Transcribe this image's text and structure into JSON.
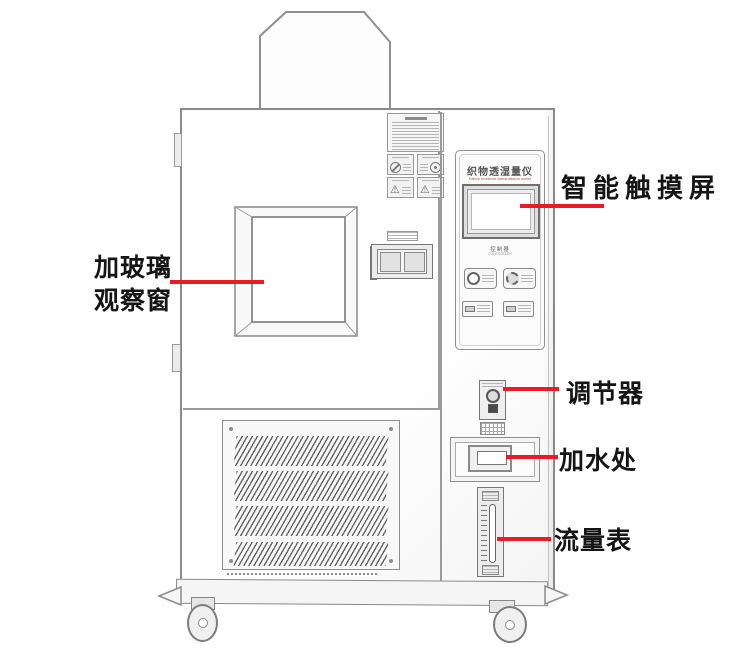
{
  "colors": {
    "callout_red": "#ea1c23",
    "label_text": "#151515",
    "sketch_line": "#8f8f8f"
  },
  "callouts": {
    "touchscreen": {
      "label": "智能触摸屏"
    },
    "window": {
      "line1": "加玻璃",
      "line2": "观察窗"
    },
    "regulator": {
      "label": "调节器"
    },
    "water_inlet": {
      "label": "加水处"
    },
    "flow_meter": {
      "label": "流量表"
    }
  },
  "machine": {
    "control_panel": {
      "title": "织物透湿量仪",
      "subtitle_en": "Fabric moisture transmission meter",
      "controller_label": "控制器",
      "controller_label_en": "CONTROLLER"
    },
    "icons": {
      "warning_triangle": "⚠"
    }
  }
}
